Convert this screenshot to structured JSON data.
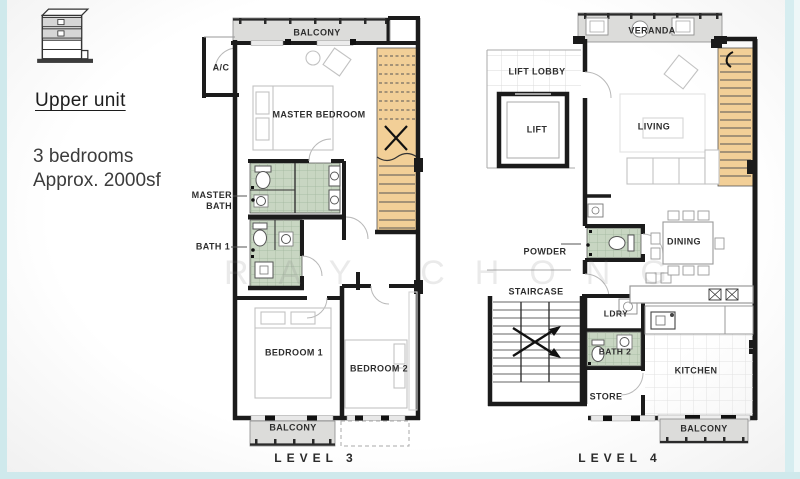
{
  "page": {
    "background": "#ffffff",
    "border_color": "#cfe9ec"
  },
  "sidebar": {
    "icon": "building-upper-unit-icon",
    "title": "Upper unit",
    "line1": "3 bedrooms",
    "line2": "Approx. 2000sf"
  },
  "watermark": "RAY CHONG",
  "colors": {
    "bathroom_fill": "#c8d6c2",
    "stair_fill": "#f2cf97",
    "balcony_fill": "#dcdcda",
    "wall": "#1b1b1b",
    "furniture": "#c2c2c2"
  },
  "level3": {
    "name": "LEVEL 3",
    "rooms": {
      "balcony_top": "BALCONY",
      "ac": "A/C",
      "master_bedroom": "MASTER BEDROOM",
      "master_bath": "MASTER BATH",
      "bath1": "BATH 1",
      "bedroom1": "BEDROOM 1",
      "bedroom2": "BEDROOM 2",
      "balcony_bottom": "BALCONY"
    }
  },
  "level4": {
    "name": "LEVEL 4",
    "rooms": {
      "veranda": "VERANDA",
      "lift_lobby": "LIFT LOBBY",
      "lift": "LIFT",
      "living": "LIVING",
      "powder": "POWDER",
      "dining": "DINING",
      "staircase": "STAIRCASE",
      "ldry": "LDRY",
      "bath2": "BATH 2",
      "kitchen": "KITCHEN",
      "store": "STORE",
      "balcony": "BALCONY"
    }
  }
}
